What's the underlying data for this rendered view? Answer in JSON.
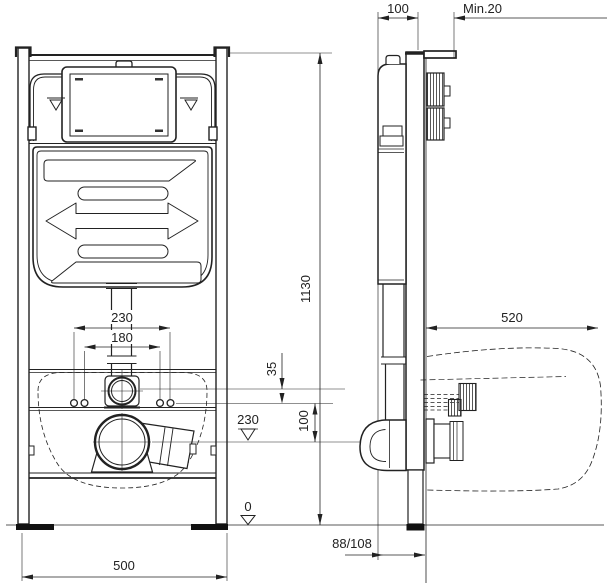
{
  "canvas": {
    "background": "#ffffff",
    "line_color": "#222222",
    "dark_fill": "#111111"
  },
  "drawing": {
    "dims": {
      "frame_width": "500",
      "frame_height": "1130",
      "bolt_spacing_outer": "230",
      "bolt_spacing_inner": "180",
      "flush_to_bolt_offset": "35",
      "bolt_to_outlet": "100",
      "outlet_level": "230",
      "floor_level": "0",
      "frame_depth": "100",
      "min_clearance": "Min.20",
      "installation_depth": "520",
      "outlet_wall_distance": "88/108"
    }
  }
}
